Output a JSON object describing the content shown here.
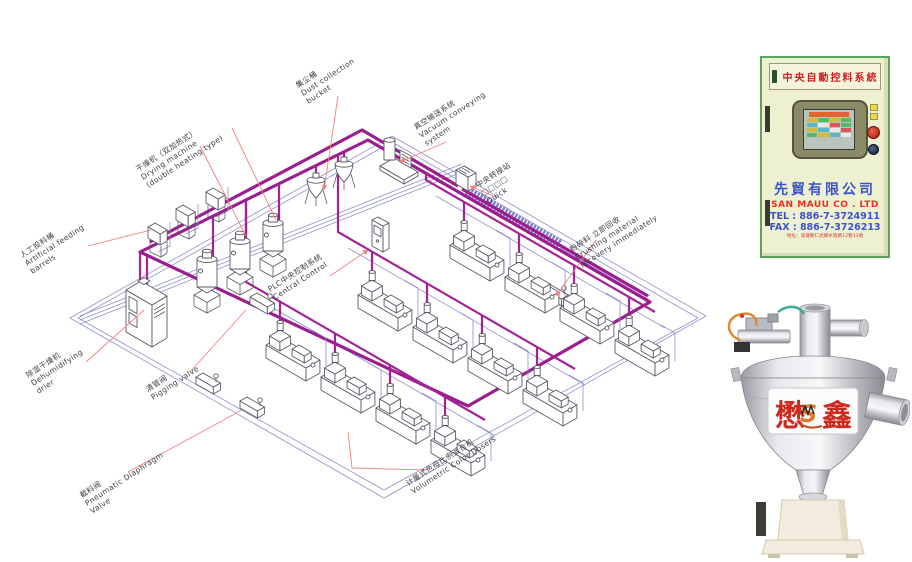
{
  "diagram": {
    "labels": {
      "feeding_barrels": {
        "lines": [
          "人工投料桶",
          "Artificial feeding",
          "barrels"
        ]
      },
      "dehumidifying_dryer": {
        "lines": [
          "除湿干燥机",
          "Dehumidifying",
          "drier"
        ]
      },
      "drying_machine": {
        "lines": [
          "干燥机（双加热式）",
          "Drying machine",
          "(double heating type)"
        ]
      },
      "dust_collection": {
        "lines": [
          "集尘桶",
          "Dust collection",
          "bucket"
        ]
      },
      "vacuum_conveying": {
        "lines": [
          "真空输送系统",
          "Vacuum conveying",
          "system"
        ]
      },
      "transfer_station": {
        "lines": [
          "中央转接站",
          "□□□□",
          "Quick"
        ]
      },
      "plc_control": {
        "lines": [
          "PLC中央控制系统",
          "Central Control"
        ]
      },
      "pigging_valve": {
        "lines": [
          "清管阀",
          "Pigging valve"
        ]
      },
      "diaphragm_valve": {
        "lines": [
          "截料阀",
          "Pneumatic Diaphragm",
          "Valve"
        ]
      },
      "color_dosers": {
        "lines": [
          "计量式色母比例混合机",
          "Volumetric Color Dosers"
        ]
      },
      "crushing_recovery": {
        "lines": [
          "粉碎料 立即回收",
          "Crushing material",
          "recovery immediately"
        ]
      }
    },
    "colors": {
      "pipe_magenta": "#9c1d8f",
      "pipe_blue": "#8f92cc",
      "leader_red": "#ef8080",
      "outline_gray": "#5a5a66"
    }
  },
  "cabinet": {
    "header": "中央自動控料系統",
    "company_zh": "先貿有限公司",
    "company_en": "SAN MAUU CO . LTD",
    "tel": "TEL : 886-7-3724911",
    "fax": "FAX : 886-7-3726213",
    "address": "地址：高雄縣仁武鄉水管路12巷33號"
  },
  "hopper": {
    "brand_left": "懋",
    "brand_right": "鑫",
    "logo_letter": "S"
  }
}
